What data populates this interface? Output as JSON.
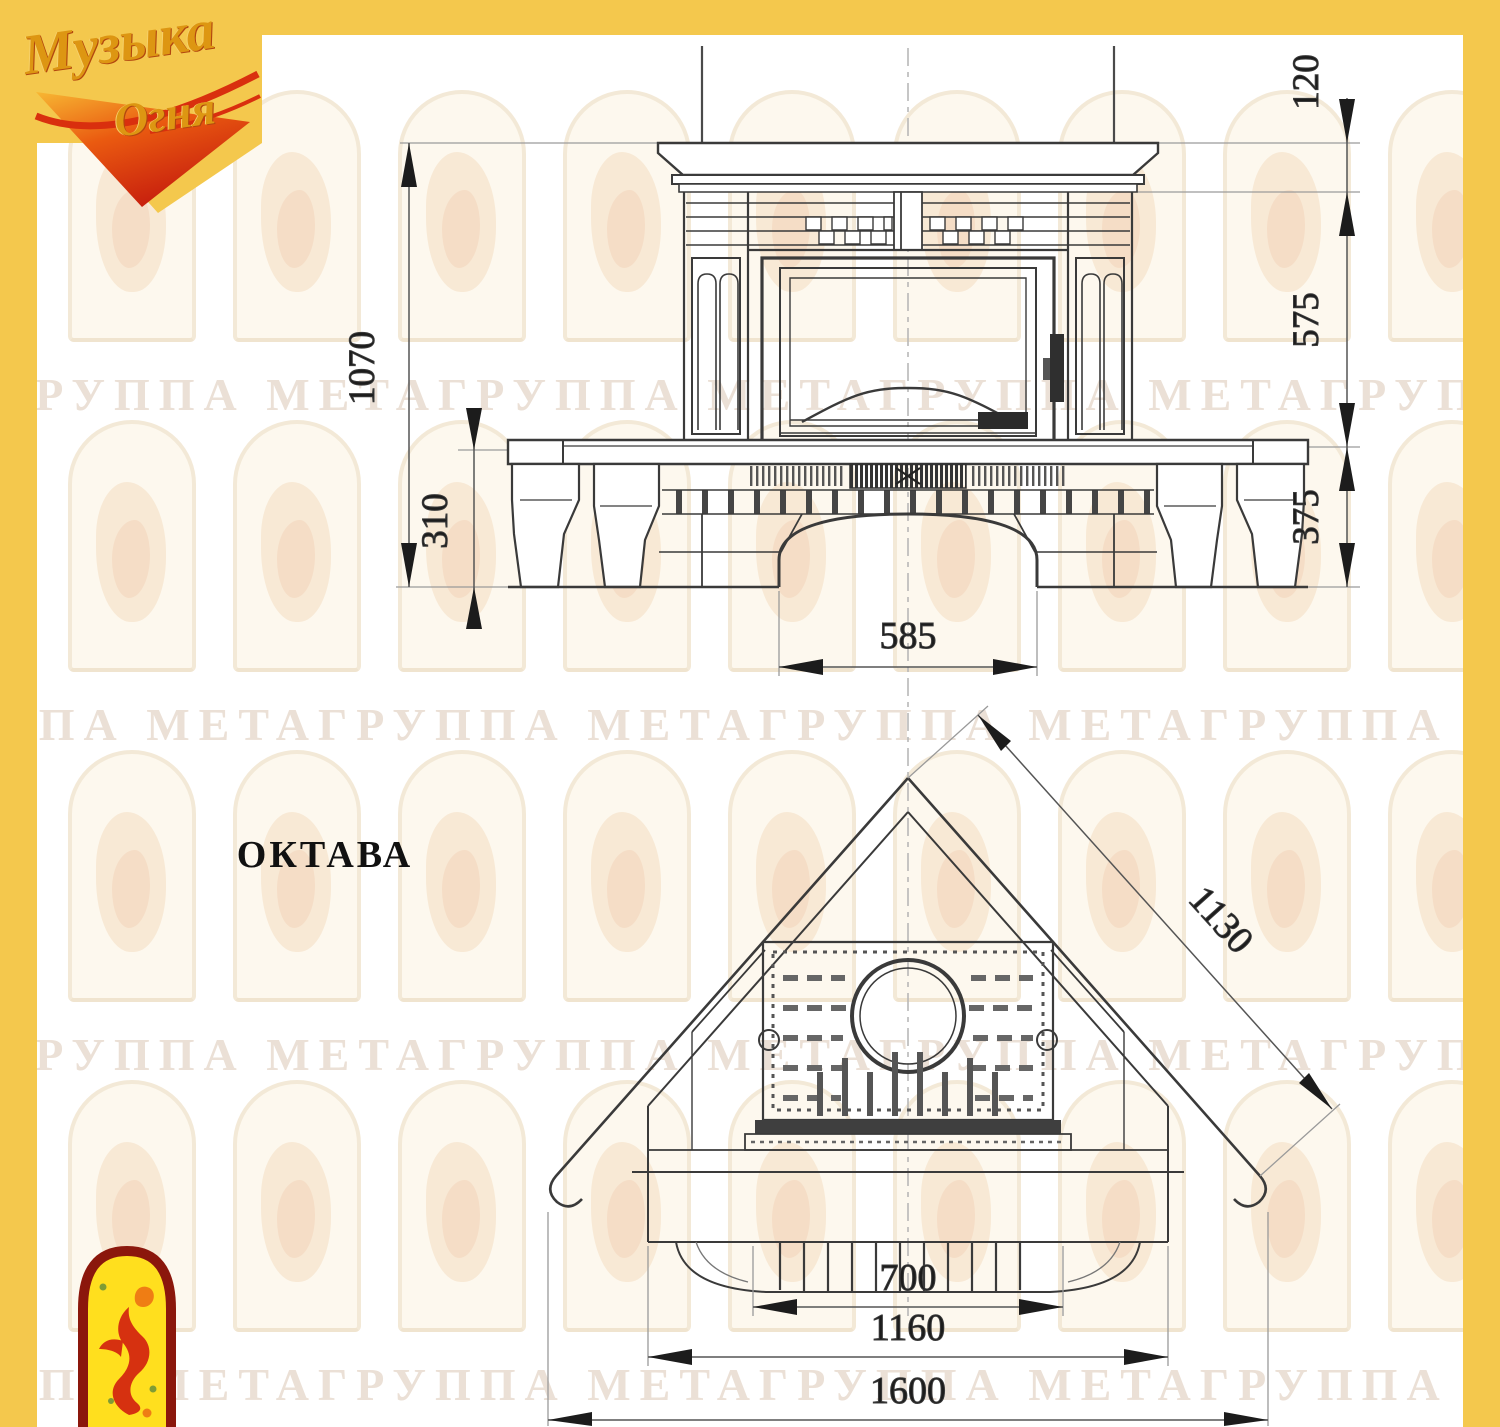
{
  "model_label": "ОКТАВА",
  "brand_logo": {
    "word1": "Музыка",
    "word2": "Огня"
  },
  "icons": {
    "brand_logo": "muzyka-ognya-script-logo",
    "corner_logo": "flame-dancer-arch-icon"
  },
  "watermark": {
    "unit": "ГРУППА МЕТА",
    "band_text": "ГРУППА МЕТАГРУППА МЕТАГРУППА МЕТАГРУППА МЕТАГРУППА МЕТАГРУППА МЕТА",
    "band_count": 4
  },
  "front_view": {
    "dimensions": {
      "total_height": "1070",
      "shelf_height": "120",
      "body_height": "575",
      "base_height": "375",
      "hearth_height": "310",
      "arch_width": "585"
    }
  },
  "plan_view": {
    "dimensions": {
      "diagonal_width": "1130",
      "firebox_width": "700",
      "hearth_width": "1160",
      "overall_width": "1600"
    }
  },
  "colors": {
    "frame_yellow": "#f4c84d",
    "line_dark": "#3a3a3a",
    "dim_text": "#1c1c1c",
    "watermark_text": "#ebe0d6",
    "logo_gold": "#dd9612",
    "logo_red": "#d92f0e"
  }
}
